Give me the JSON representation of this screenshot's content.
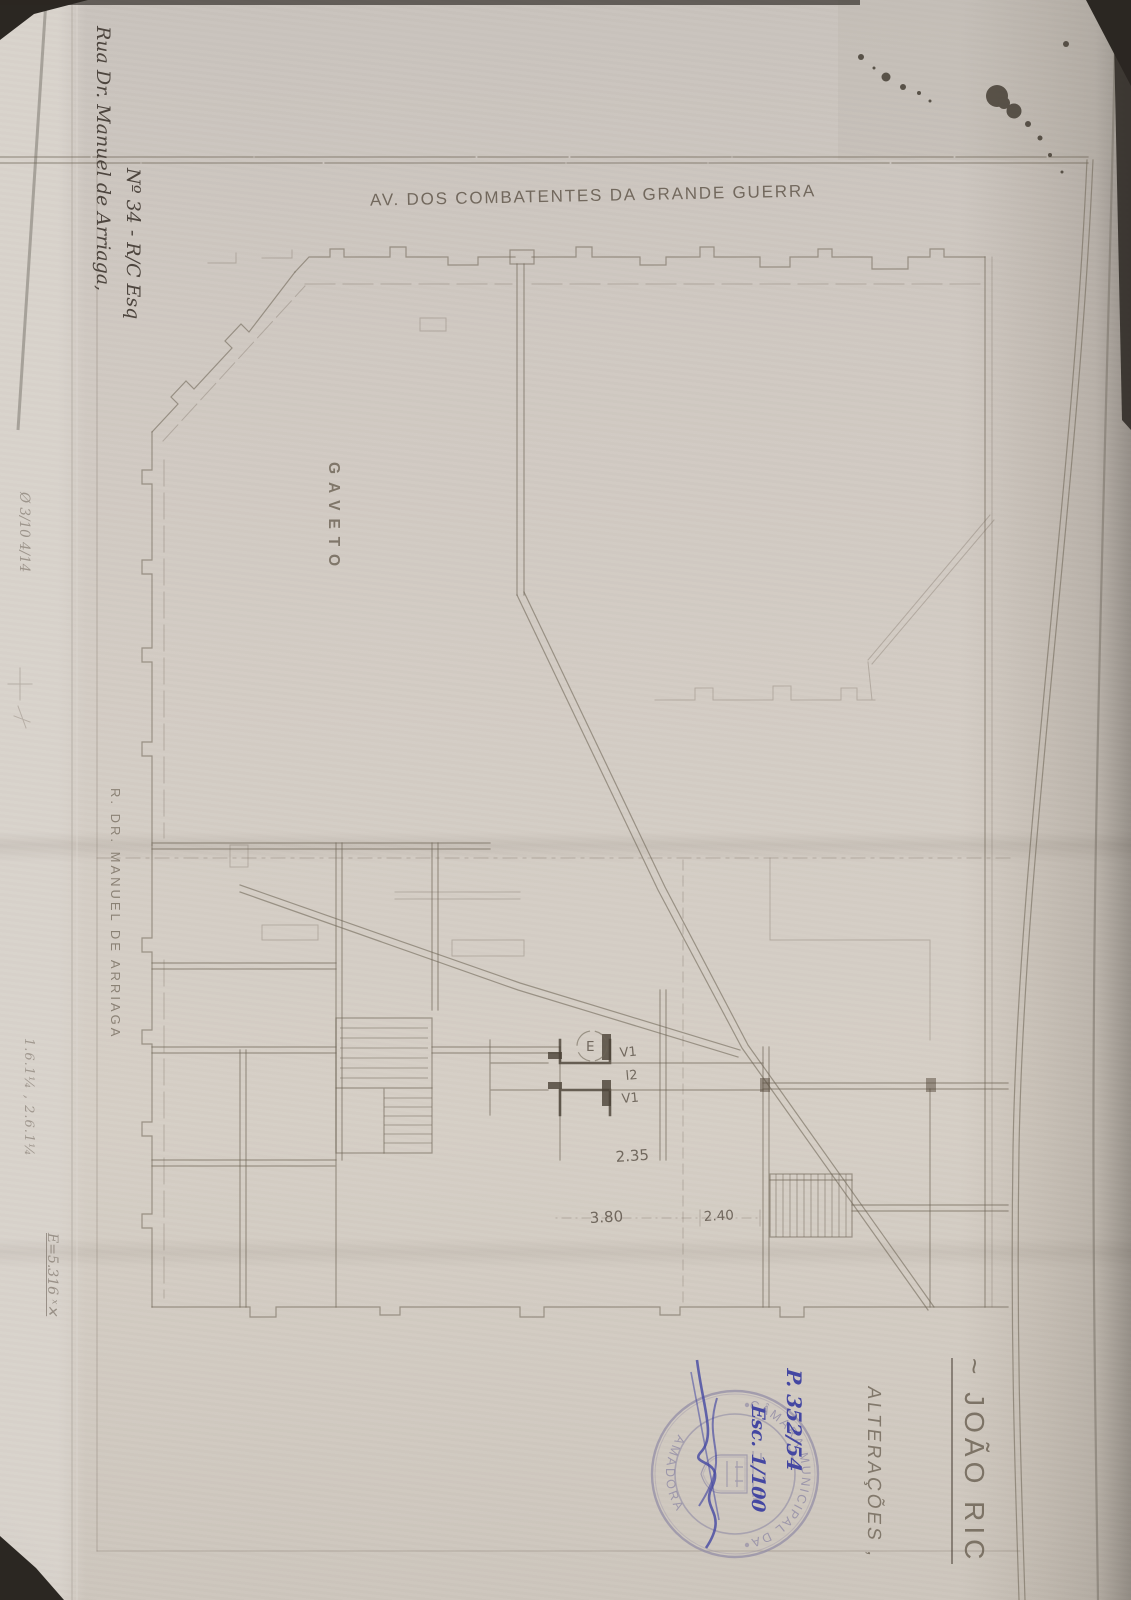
{
  "plan": {
    "street_top": "AV. DOS COMBATENTES DA GRANDE GUERRA",
    "corner": "GAVETO",
    "street_left": "R. DR. MANUEL DE ARRIAGA",
    "entrance": "E",
    "labels": {
      "v1_top": "V1",
      "l2": "l2",
      "v1_bottom": "V1"
    },
    "dims": {
      "d235": "2.35",
      "d380": "3.80",
      "d240": "2.40"
    }
  },
  "handwriting": {
    "address1": "Rua Dr. Manuel de Arriaga,",
    "address2": "Nº 34 - R/C Esq",
    "process": "P. 352/54",
    "scale": "Esc. 1/100",
    "pencil_top": "Ø 3/10 4/14",
    "pencil_bottom": "1.6.1¼ , 2.6.1¼",
    "pencil_ref": "E=5.316 ˣ✕"
  },
  "stamp": {
    "arc_top": "CÂMARA MUNICIPAL DA",
    "arc_bottom": "AMADORA"
  },
  "side": {
    "alteracoes": "ALTERAÇÕES ,",
    "owner": "~ JOÃO RIC"
  },
  "colors": {
    "paper": "#d1cac2",
    "plan_line": "#6f6557",
    "pencil": "#5f564b",
    "blue_ink": "#4447a2",
    "stamp_violet": "#8e88a4",
    "edge": "#2b2722"
  }
}
